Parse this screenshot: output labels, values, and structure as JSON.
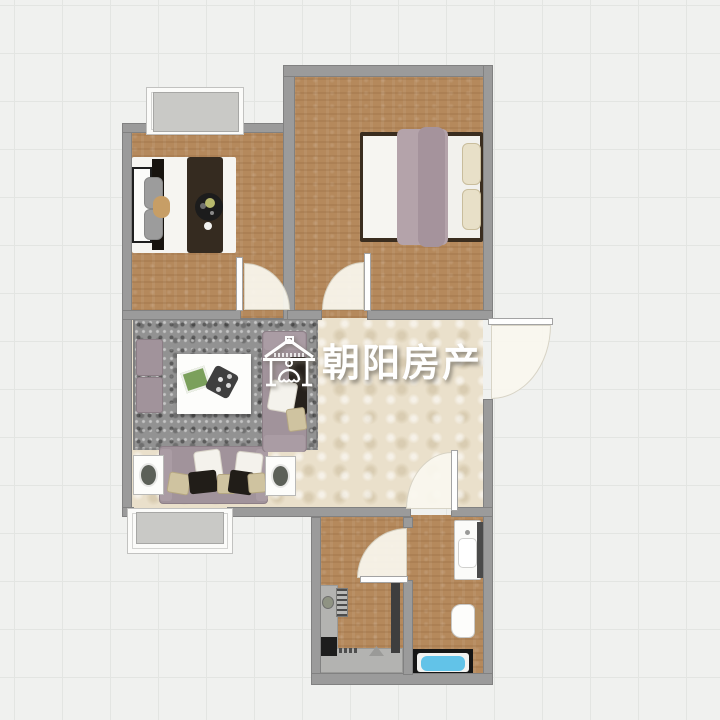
{
  "watermark": {
    "brand": "朝阳房产",
    "icon": "house-logo-icon",
    "text_color": "#ffffff"
  },
  "palette": {
    "background": "#f0f1ef",
    "grid_line": "#e3e5e2",
    "wall": "#9b9b9b",
    "wood_floor": "#b5895c",
    "tile_floor": "#eae0cb",
    "rug": "#929292",
    "sofa_mauve": "#a1939b",
    "bed_blanket_dark": "#352b20",
    "bed_blanket_mauve": "#b4a3aa",
    "bathtub_water": "#62c3e8",
    "door_leaf": "#fefefe",
    "window_slab": "#c9c9c6"
  }
}
